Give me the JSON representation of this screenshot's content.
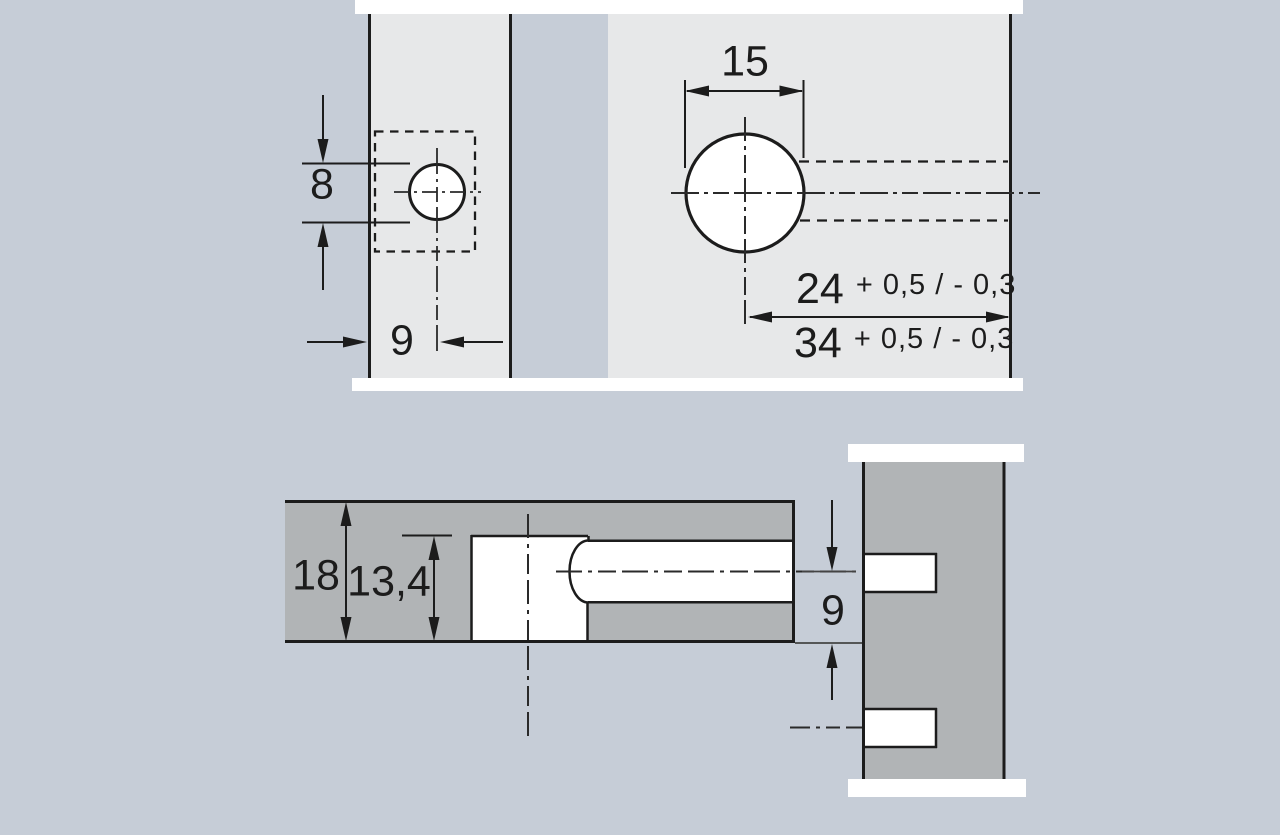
{
  "drawing": {
    "title": "drilling-pattern-technical-drawing",
    "colors": {
      "background": "#c6cdd7",
      "panel_face": "#e7e8e9",
      "panel_section": "#b1b4b6",
      "line": "#1c1c1c",
      "white": "#ffffff"
    },
    "top_view": {
      "hole_diameter_small": "8",
      "edge_distance": "9",
      "hole_diameter_large": "15",
      "distance_a": "24",
      "distance_a_tolerance": "+ 0,5 / - 0,3",
      "distance_b": "34",
      "distance_b_tolerance": "+ 0,5 / - 0,3"
    },
    "section_view": {
      "panel_thickness": "18",
      "drilling_depth": "13,4",
      "center_distance": "9"
    }
  }
}
